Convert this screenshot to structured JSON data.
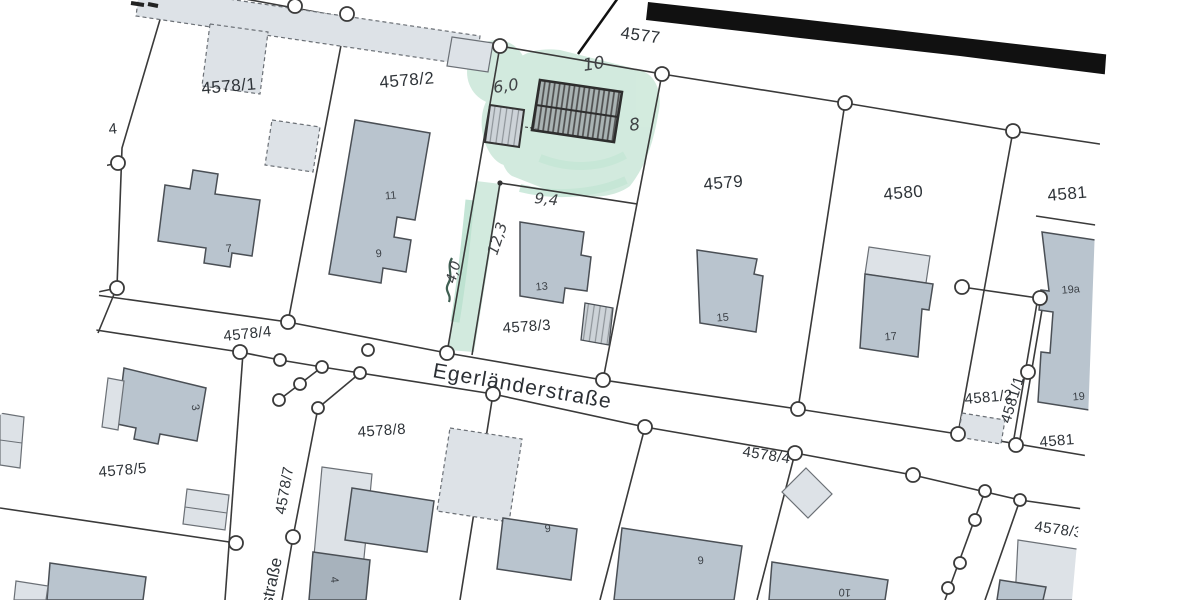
{
  "parcels": {
    "p4577": "4577",
    "p4578_1": "4578/1",
    "p4578_2": "4578/2",
    "p4578_3": "4578/3",
    "p4578_3_cut": "4578/3",
    "p4578_4_left": "4578/4",
    "p4578_4_right": "4578/4",
    "p4578_5": "4578/5",
    "p4578_7": "4578/7",
    "p4578_8": "4578/8",
    "p4579": "4579",
    "p4580": "4580",
    "p4581_top": "4581",
    "p4581_bottom": "4581",
    "p4581_1": "4581/1",
    "p4581_2": "4581/2",
    "fragment_left": "4"
  },
  "streets": {
    "egerlaenderstrasse": "Egerländerstraße",
    "strasse_partial": "straße"
  },
  "house_numbers": {
    "h7": "7",
    "h11": "11",
    "h9_upper": "9",
    "h13": "13",
    "h15": "15",
    "h17": "17",
    "h19a": "19a",
    "h19": "19",
    "h3": "3",
    "h4": "4",
    "h9_south_west": "9",
    "h9_south_east": "9",
    "h10": "10"
  },
  "annotations": {
    "garage_width": "6,0",
    "new_building_length": "10",
    "new_building_width": "8",
    "dist_9_4": "9,4",
    "dist_12_3": "12,3",
    "strip_width_4_0": "4,0"
  },
  "colors": {
    "highlight_green": "#c8e6d6",
    "building_fill": "#b9c4ce",
    "building_light_fill": "#dde2e7",
    "boundary_line": "#3a3a3a",
    "road_band_black": "#111111",
    "pencil": "#3f4245"
  }
}
